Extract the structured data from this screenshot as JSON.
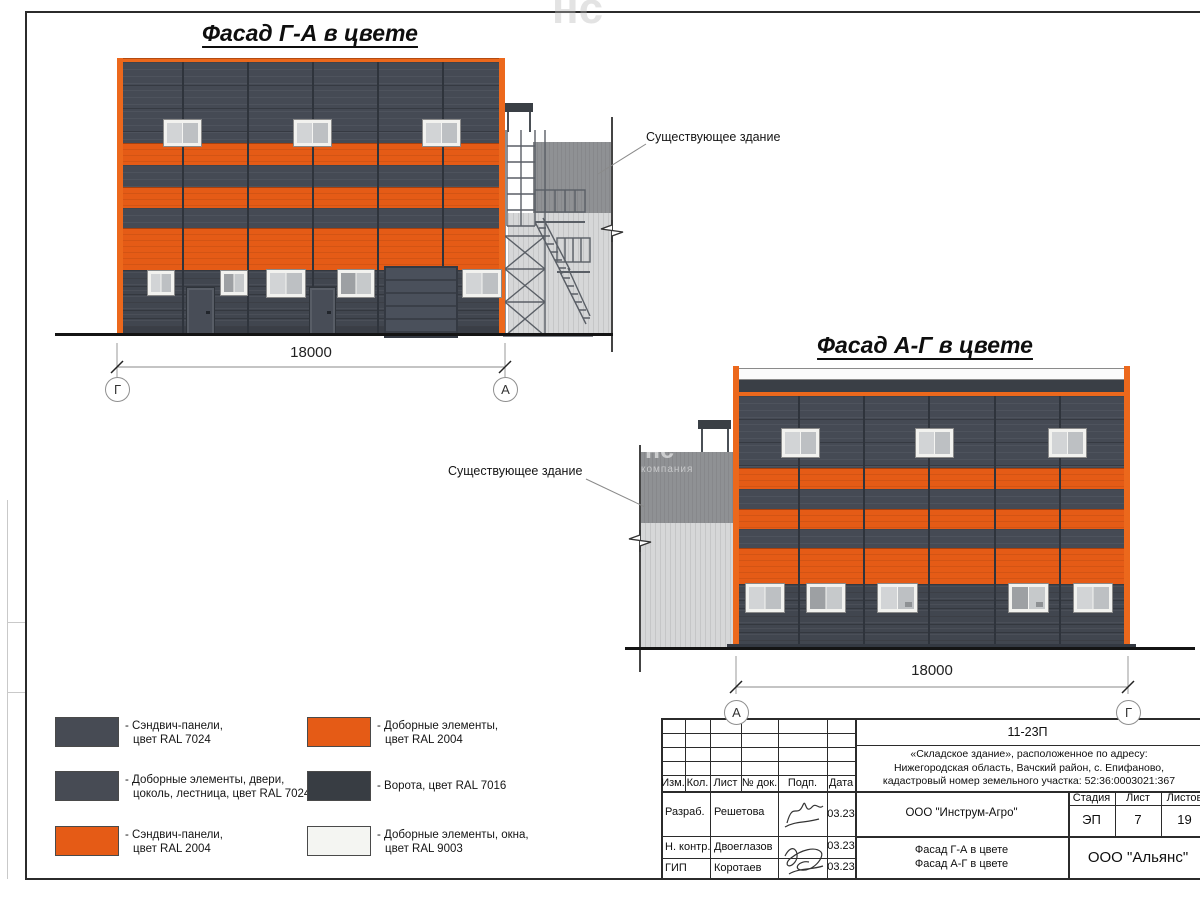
{
  "sheet": {
    "watermark_top": "нс"
  },
  "facade_left": {
    "title": "Фасад Г-А в цвете",
    "dimension_label": "18000",
    "axis_left": "Г",
    "axis_right": "А",
    "existing_building_label": "Существующее здание"
  },
  "facade_right": {
    "title": "Фасад А-Г в цвете",
    "dimension_label": "18000",
    "axis_left": "А",
    "axis_right": "Г",
    "existing_building_label": "Существующее здание",
    "watermark_line1": "нс",
    "watermark_line2": "компания"
  },
  "legend": {
    "items": [
      {
        "color": "#474B54",
        "lines": [
          "- Сэндвич-панели,",
          "цвет RAL 7024"
        ]
      },
      {
        "color": "#474B54",
        "lines": [
          "- Доборные элементы, двери,",
          "цоколь, лестница, цвет RAL 7024"
        ]
      },
      {
        "color": "#E55B16",
        "lines": [
          "- Сэндвич-панели,",
          "цвет RAL 2004"
        ]
      },
      {
        "color": "#E55B16",
        "lines": [
          "- Доборные элементы,",
          "цвет RAL 2004"
        ]
      },
      {
        "color": "#383D43",
        "lines": [
          "- Ворота, цвет RAL 7016",
          ""
        ]
      },
      {
        "color": "#F4F5F2",
        "lines": [
          "- Доборные элементы, окна,",
          "цвет RAL 9003"
        ]
      }
    ]
  },
  "title_block": {
    "doc_code": "11-23П",
    "object_lines": [
      "«Складское здание», расположенное по адресу:",
      "Нижегородская область, Вачский район, с. Епифаново,",
      "кадастровый номер земельного участка: 52:36:0003021:367"
    ],
    "org": "ООО \"Инструм-Агро\"",
    "stage_header": [
      "Стадия",
      "Лист",
      "Листов"
    ],
    "stage_value": "ЭП",
    "sheet_value": "7",
    "sheets_total_value": "19",
    "drawing_name_lines": [
      "Фасад Г-А в цвете",
      "Фасад А-Г в цвете"
    ],
    "company": "ООО \"Альянс\"",
    "rev_headers": [
      "Изм.",
      "Кол.",
      "Лист",
      "№ док.",
      "Подп.",
      "Дата"
    ],
    "staff_rows": [
      {
        "role": "Разраб.",
        "name": "Решетова",
        "date": "03.23"
      },
      {
        "role": "Н. контр.",
        "name": "Двоеглазов",
        "date": "03.23"
      },
      {
        "role": "ГИП",
        "name": "Коротаев",
        "date": "03.23"
      }
    ]
  },
  "colors": {
    "panel_dark": "#454A54",
    "panel_orange": "#E55B16",
    "trim_orange": "#EC681C",
    "gate_dark": "#4A505B",
    "window_white": "#F2F2EF",
    "existing_dark": "#8F9194",
    "existing_light": "#D6D7D8"
  }
}
